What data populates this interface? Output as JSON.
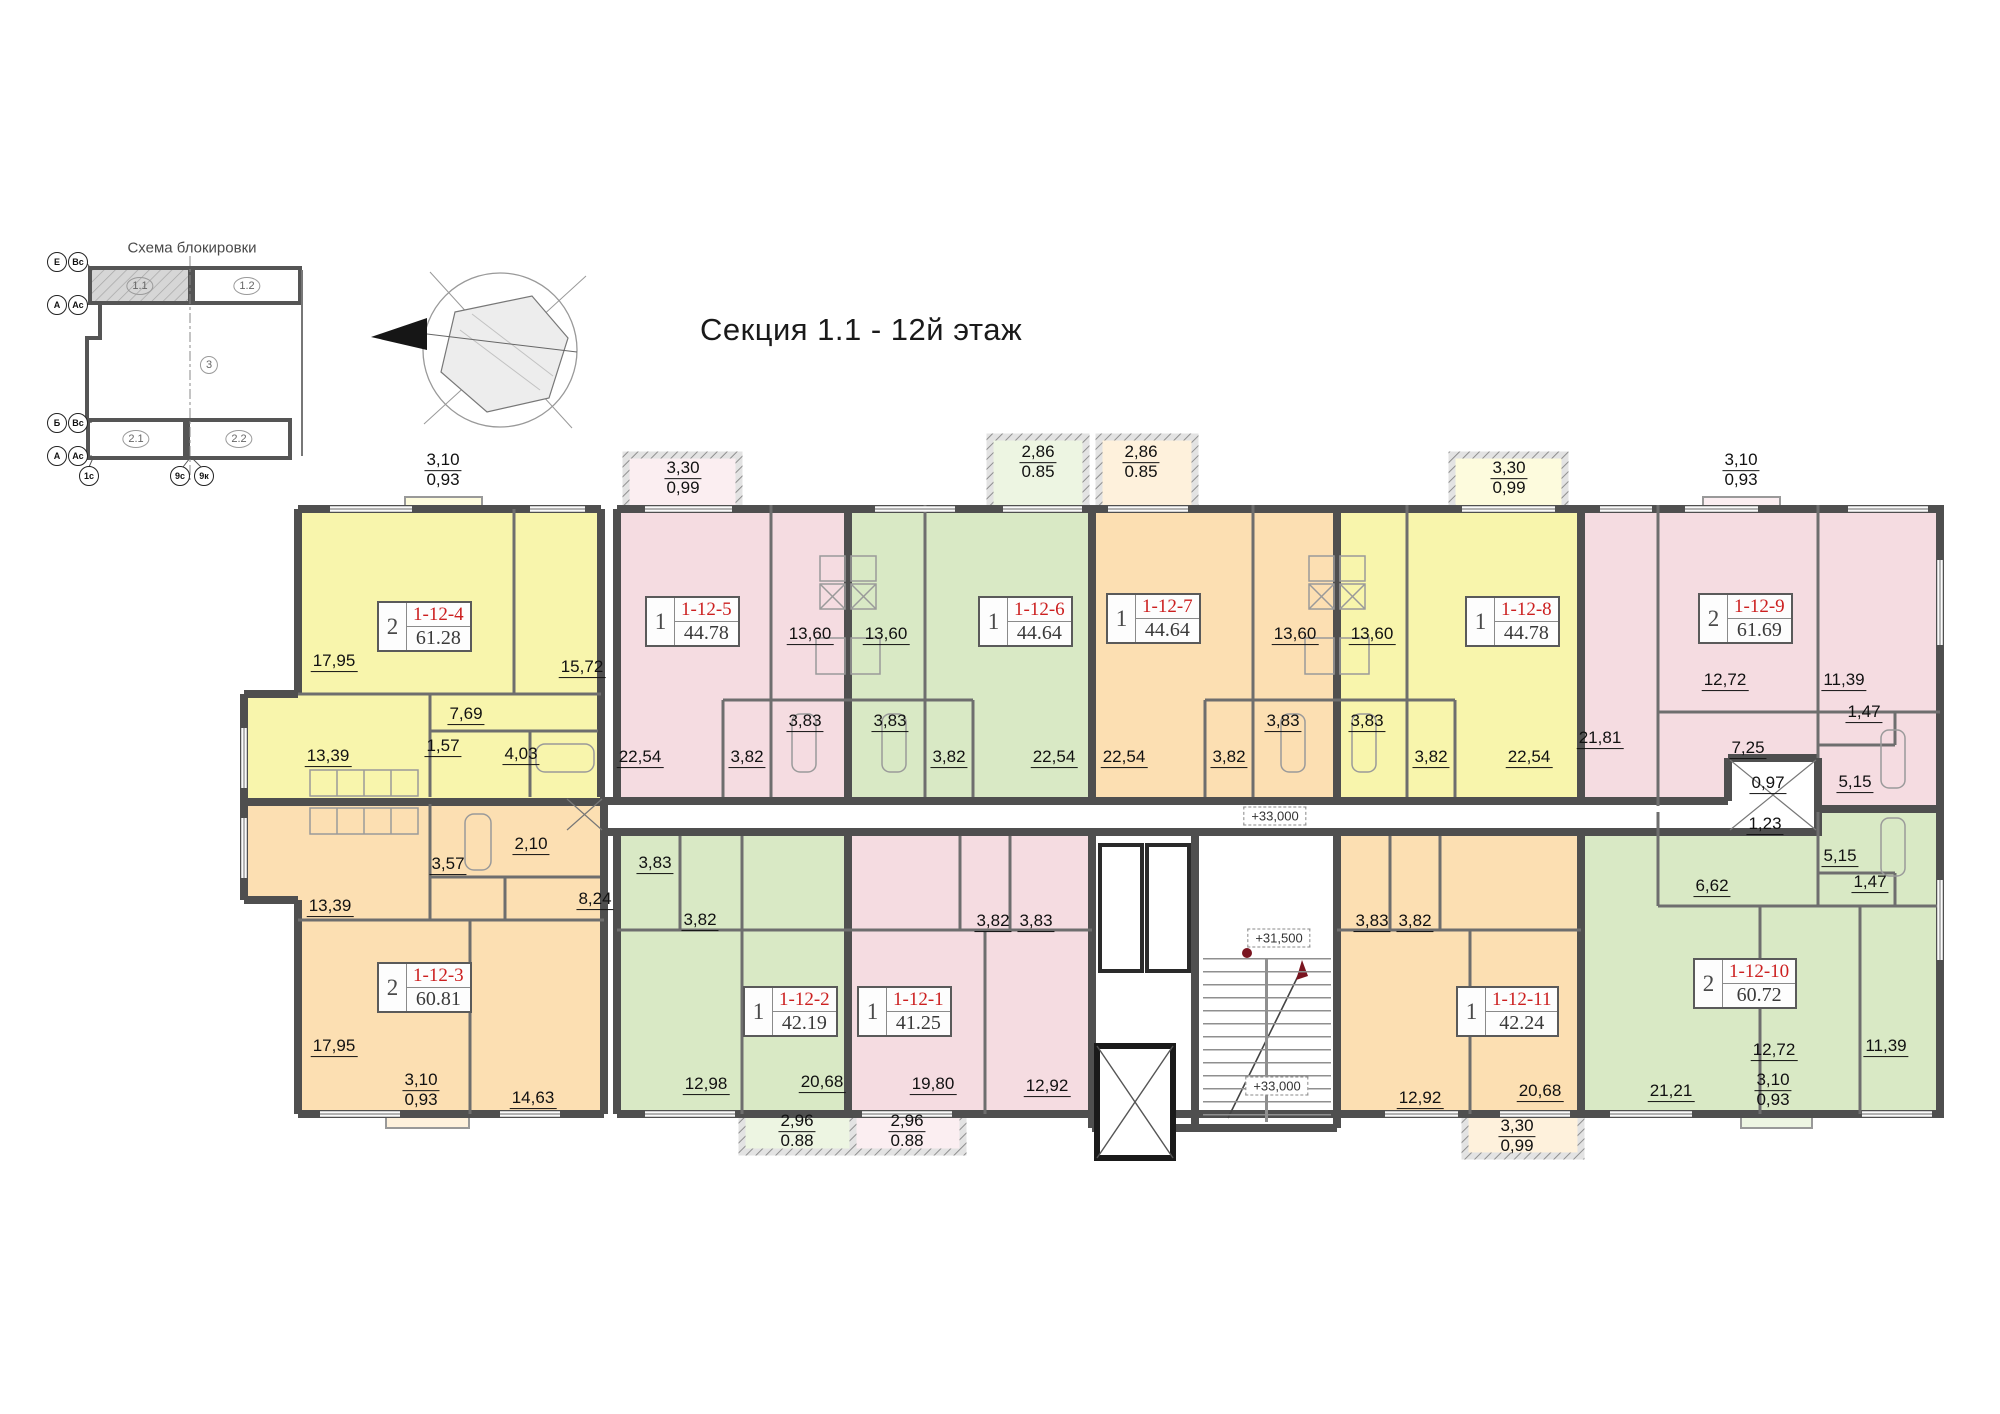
{
  "header": {
    "title": "Секция 1.1 - 12й этаж"
  },
  "scheme": {
    "title": "Схема блокировки",
    "sections": [
      {
        "label": "1.1",
        "x": 140,
        "y": 286,
        "current": true
      },
      {
        "label": "1.2",
        "x": 247,
        "y": 286,
        "current": false
      },
      {
        "label": "3",
        "x": 209,
        "y": 365,
        "current": false
      },
      {
        "label": "2.1",
        "x": 136,
        "y": 439,
        "current": false
      },
      {
        "label": "2.2",
        "x": 239,
        "y": 439,
        "current": false
      }
    ],
    "axis_circles": [
      {
        "label": "Е",
        "x": 57,
        "y": 262
      },
      {
        "label": "Вс",
        "x": 78,
        "y": 262
      },
      {
        "label": "А",
        "x": 57,
        "y": 305
      },
      {
        "label": "Ас",
        "x": 78,
        "y": 305
      },
      {
        "label": "Б",
        "x": 57,
        "y": 423
      },
      {
        "label": "Вс",
        "x": 78,
        "y": 423
      },
      {
        "label": "А",
        "x": 57,
        "y": 456
      },
      {
        "label": "Ас",
        "x": 78,
        "y": 456
      },
      {
        "label": "1с",
        "x": 89,
        "y": 476
      },
      {
        "label": "9с",
        "x": 180,
        "y": 476
      },
      {
        "label": "9к",
        "x": 204,
        "y": 476
      }
    ]
  },
  "colors": {
    "yellow": "#f8f5ac",
    "pink": "#f5dce1",
    "green": "#d9e9c5",
    "orange": "#fcdfb2",
    "unit_id_red": "#cc1f1f",
    "wall": "#4f4f4f"
  },
  "plan": {
    "units": [
      {
        "id": "1-12-4",
        "rooms": "2",
        "area": "61.28",
        "x": 377,
        "y": 601
      },
      {
        "id": "1-12-5",
        "rooms": "1",
        "area": "44.78",
        "x": 645,
        "y": 596
      },
      {
        "id": "1-12-6",
        "rooms": "1",
        "area": "44.64",
        "x": 978,
        "y": 596
      },
      {
        "id": "1-12-7",
        "rooms": "1",
        "area": "44.64",
        "x": 1106,
        "y": 593
      },
      {
        "id": "1-12-8",
        "rooms": "1",
        "area": "44.78",
        "x": 1465,
        "y": 596
      },
      {
        "id": "1-12-9",
        "rooms": "2",
        "area": "61.69",
        "x": 1698,
        "y": 593
      },
      {
        "id": "1-12-3",
        "rooms": "2",
        "area": "60.81",
        "x": 377,
        "y": 962
      },
      {
        "id": "1-12-2",
        "rooms": "1",
        "area": "42.19",
        "x": 743,
        "y": 986
      },
      {
        "id": "1-12-1",
        "rooms": "1",
        "area": "41.25",
        "x": 857,
        "y": 986
      },
      {
        "id": "1-12-11",
        "rooms": "1",
        "area": "42.24",
        "x": 1456,
        "y": 986
      },
      {
        "id": "1-12-10",
        "rooms": "2",
        "area": "60.72",
        "x": 1693,
        "y": 958
      }
    ],
    "dimensions": [
      {
        "t": "17,95",
        "x": 334,
        "y": 662
      },
      {
        "t": "15,72",
        "x": 582,
        "y": 668
      },
      {
        "t": "13,39",
        "x": 328,
        "y": 757
      },
      {
        "t": "7,69",
        "x": 466,
        "y": 715
      },
      {
        "t": "1,57",
        "x": 443,
        "y": 747
      },
      {
        "t": "4,03",
        "x": 521,
        "y": 755
      },
      {
        "t": "22,54",
        "x": 640,
        "y": 758
      },
      {
        "t": "3,82",
        "x": 747,
        "y": 758
      },
      {
        "t": "13,60",
        "x": 810,
        "y": 635
      },
      {
        "t": "13,60",
        "x": 886,
        "y": 635
      },
      {
        "t": "3,83",
        "x": 805,
        "y": 722
      },
      {
        "t": "3,83",
        "x": 890,
        "y": 722
      },
      {
        "t": "3,82",
        "x": 949,
        "y": 758
      },
      {
        "t": "22,54",
        "x": 1054,
        "y": 758
      },
      {
        "t": "22,54",
        "x": 1124,
        "y": 758
      },
      {
        "t": "3,82",
        "x": 1229,
        "y": 758
      },
      {
        "t": "13,60",
        "x": 1295,
        "y": 635
      },
      {
        "t": "13,60",
        "x": 1372,
        "y": 635
      },
      {
        "t": "3,83",
        "x": 1283,
        "y": 722
      },
      {
        "t": "3,83",
        "x": 1367,
        "y": 722
      },
      {
        "t": "3,82",
        "x": 1431,
        "y": 758
      },
      {
        "t": "22,54",
        "x": 1529,
        "y": 758
      },
      {
        "t": "21,81",
        "x": 1600,
        "y": 739
      },
      {
        "t": "12,72",
        "x": 1725,
        "y": 681
      },
      {
        "t": "11,39",
        "x": 1844,
        "y": 681
      },
      {
        "t": "1,47",
        "x": 1864,
        "y": 713
      },
      {
        "t": "7,25",
        "x": 1748,
        "y": 749
      },
      {
        "t": "0,97",
        "x": 1768,
        "y": 784
      },
      {
        "t": "5,15",
        "x": 1855,
        "y": 783
      },
      {
        "t": "1,23",
        "x": 1765,
        "y": 825
      },
      {
        "t": "5,15",
        "x": 1840,
        "y": 857
      },
      {
        "t": "1,47",
        "x": 1870,
        "y": 883
      },
      {
        "t": "6,62",
        "x": 1712,
        "y": 887
      },
      {
        "t": "13,39",
        "x": 330,
        "y": 907
      },
      {
        "t": "3,57",
        "x": 448,
        "y": 865
      },
      {
        "t": "2,10",
        "x": 531,
        "y": 845
      },
      {
        "t": "8,24",
        "x": 595,
        "y": 900
      },
      {
        "t": "17,95",
        "x": 334,
        "y": 1047
      },
      {
        "t": "14,63",
        "x": 533,
        "y": 1099
      },
      {
        "t": "12,98",
        "x": 706,
        "y": 1085
      },
      {
        "t": "20,68",
        "x": 822,
        "y": 1083
      },
      {
        "t": "3,83",
        "x": 655,
        "y": 864
      },
      {
        "t": "3,82",
        "x": 700,
        "y": 921
      },
      {
        "t": "3,82",
        "x": 993,
        "y": 922
      },
      {
        "t": "3,83",
        "x": 1036,
        "y": 922
      },
      {
        "t": "19,80",
        "x": 933,
        "y": 1085
      },
      {
        "t": "12,92",
        "x": 1047,
        "y": 1087
      },
      {
        "t": "3,83",
        "x": 1372,
        "y": 922
      },
      {
        "t": "3,82",
        "x": 1415,
        "y": 922
      },
      {
        "t": "12,92",
        "x": 1420,
        "y": 1099
      },
      {
        "t": "20,68",
        "x": 1540,
        "y": 1092
      },
      {
        "t": "21,21",
        "x": 1671,
        "y": 1092
      },
      {
        "t": "12,72",
        "x": 1774,
        "y": 1051
      },
      {
        "t": "11,39",
        "x": 1886,
        "y": 1047
      }
    ],
    "dimensions_stacked": [
      {
        "a": "3,10",
        "b": "0,93",
        "x": 443,
        "y": 470
      },
      {
        "a": "3,30",
        "b": "0,99",
        "x": 683,
        "y": 478
      },
      {
        "a": "2,86",
        "b": "0.85",
        "x": 1038,
        "y": 462
      },
      {
        "a": "2,86",
        "b": "0.85",
        "x": 1141,
        "y": 462
      },
      {
        "a": "3,30",
        "b": "0,99",
        "x": 1509,
        "y": 478
      },
      {
        "a": "3,10",
        "b": "0,93",
        "x": 1741,
        "y": 470
      },
      {
        "a": "3,10",
        "b": "0,93",
        "x": 421,
        "y": 1090
      },
      {
        "a": "2,96",
        "b": "0.88",
        "x": 797,
        "y": 1131
      },
      {
        "a": "2,96",
        "b": "0.88",
        "x": 907,
        "y": 1131
      },
      {
        "a": "3,30",
        "b": "0,99",
        "x": 1517,
        "y": 1136
      },
      {
        "a": "3,10",
        "b": "0,93",
        "x": 1773,
        "y": 1090
      }
    ],
    "levels": [
      {
        "t": "+33,000",
        "x": 1275,
        "y": 816
      },
      {
        "t": "+31,500",
        "x": 1279,
        "y": 938
      },
      {
        "t": "+33,000",
        "x": 1277,
        "y": 1086
      }
    ]
  }
}
